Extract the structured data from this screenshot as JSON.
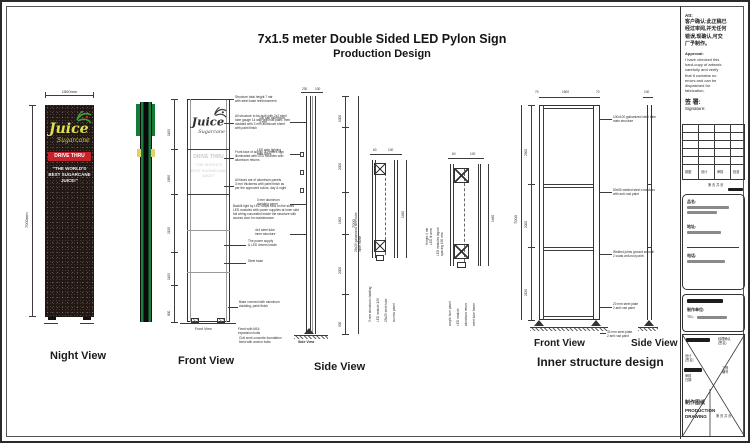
{
  "sheet": {
    "title_line1": "7x1.5 meter Double Sided LED Pylon Sign",
    "title_line2": "Production Design"
  },
  "logo": {
    "main": "Juice",
    "sub": "Sugarcane"
  },
  "colors": {
    "accent_red": "#c8232b",
    "logo_yellow": "#dde24e",
    "strip_green": "#1b7e3e",
    "pylon_black": "#221713"
  },
  "night_view": {
    "label": "Night View",
    "width_dim": "1500mm",
    "height_dim": "7000mm",
    "drive_thru": "DRIVE THRU",
    "tagline": "\"THE WORLD'S\nBEST SUGARCANE\nJUICE!\""
  },
  "front_view": {
    "label": "Front View",
    "caption": "Front View",
    "drive_thru": "DRIVE THRU",
    "tagline": "\"THE WORLD'S\nBEST SUGARCANE\nJUICE!\"",
    "dim_segments": [
      "1100",
      "1850",
      "2150",
      "1100",
      "800"
    ],
    "annotations": [
      "Structure total height 7 mtr\nwith steel base reinforcement",
      "All structure to be built with 2x2 steel\ntube gauge 14 with anti-rust paint, then\ncladded with 3 mm aluminum sheet\nwith paint finish",
      "Front face of acrylic 3D letters sign\nilluminated with LED modules with\naluminum returns",
      "All faces are of aluminum panels\n3 mm thickness with paint finish as\nper the approved colors, day & night",
      "Backlit light by LED strips runs on the sides\nLED modules with power supplies at inner side\nfull wiring concealed inside the structure with\naccess door for maintenance",
      "The power supply\n& LED drivers inside",
      "Steel base",
      "Base covered with aluminum\ncladding, paint finish",
      "Civil work concrete foundation\nfixed with anchor bolts"
    ],
    "base_note": "Fixed with M16\nexpansion bolts"
  },
  "side_view": {
    "label": "Side View",
    "caption": "Side View",
    "top_dims": [
      "230",
      "100"
    ],
    "dim_segments": [
      "1000",
      "2000",
      "1500",
      "2000",
      "500"
    ],
    "overall_dim": "7000",
    "left_notes": [
      "Top cap aluminum\n3 mm",
      "LED strip lighting\nboth sides",
      "3 mm aluminum\ncladding panel",
      "4x4 steel tube\ninner structure"
    ]
  },
  "details": {
    "a": {
      "top_dims": [
        "60",
        "100"
      ],
      "side_note": "25x25 galvanized steel tube\ninner frame",
      "height_dim": "1460",
      "bottom_notes": [
        "3 mm aluminum cladding",
        "LED module 12V",
        "25x25 steel tube",
        "access panel"
      ]
    },
    "b": {
      "top_dims": [
        "60",
        "100"
      ],
      "side_note": "LED modules layout\nspacing 150 mm",
      "height_dim": "1460",
      "bottom_notes": [
        "acrylic face panel",
        "LED module",
        "aluminum return",
        "steel tube frame"
      ]
    },
    "mid_note": "Height 4 mtr\nLED lit area"
  },
  "inner": {
    "label": "Inner structure design",
    "front_label": "Front View",
    "side_label": "Side View",
    "top_dims": [
      "70",
      "1500",
      "70"
    ],
    "side_top_dim": "100",
    "overall_dim": "7000",
    "dim_segments": [
      "2500",
      "2000",
      "2150"
    ],
    "annotations": [
      "100x100 galvanized steel tube\nmain structure",
      "50x50 welded steel crossbars\nwith anti-rust paint",
      "Welded joints ground smooth\n2 coats anti-rust paint",
      "20 mm steel plate\n2 anti rust paint",
      "30 mm steel plate\n2 anti rust paint"
    ]
  },
  "title_block": {
    "att": "Att:",
    "cn_approval": "客户确认:此正稿已\n经过审阅,并无任何\n错误,现确认,可交\n厂予制作。",
    "approval_title": "Approval:",
    "approval_body": "I have checked this\nhard-copy of artwork\ncarefully and verify\nthat it contains no\nerrors and can be\ndispatched for\nfabrication.",
    "sign_cn": "签  署:",
    "sign_en": "Signature:",
    "table_labels": [
      "制图",
      "设计",
      "审核",
      "批准"
    ],
    "page_note": "第  页  共  页",
    "fields": [
      {
        "label": "品名:"
      },
      {
        "label": "地址:"
      },
      {
        "label": "电话:"
      }
    ],
    "maker_label": "制作单位:",
    "tel_label": "TEL:",
    "mgr_label": "经理确认\n(签名)",
    "design_label": "设计\n(签名)",
    "audit_label": "审核\n日期",
    "proj_label": "工程\n编号",
    "drawing_cn": "制作图纸",
    "drawing_en": "PRODUCTION\nDRAWING"
  }
}
